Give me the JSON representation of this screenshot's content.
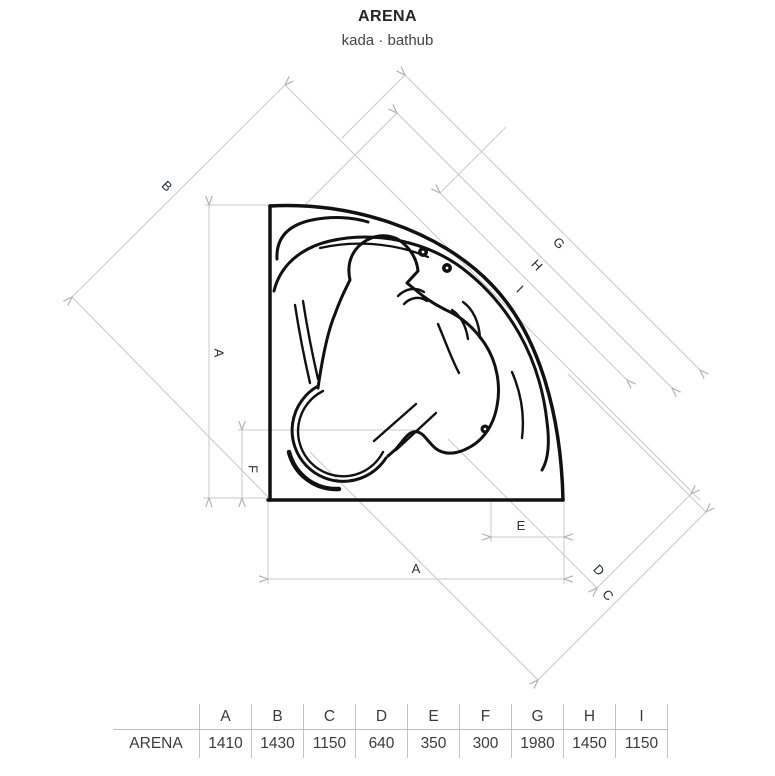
{
  "title": "ARENA",
  "subtitle": "kada · bathub",
  "drawing": {
    "labels": {
      "A": "A",
      "B": "B",
      "C": "C",
      "D": "D",
      "E": "E",
      "F": "F",
      "G": "G",
      "H": "H",
      "I": "I"
    }
  },
  "table": {
    "row_label": "ARENA",
    "columns": [
      "A",
      "B",
      "C",
      "D",
      "E",
      "F",
      "G",
      "H",
      "I"
    ],
    "values": [
      "1410",
      "1430",
      "1150",
      "640",
      "350",
      "300",
      "1980",
      "1450",
      "1150"
    ]
  },
  "colors": {
    "tub_line": "#111111",
    "construction_line": "#c9c9c9",
    "table_border": "#bcbcbc",
    "text": "#3b3b3b"
  }
}
